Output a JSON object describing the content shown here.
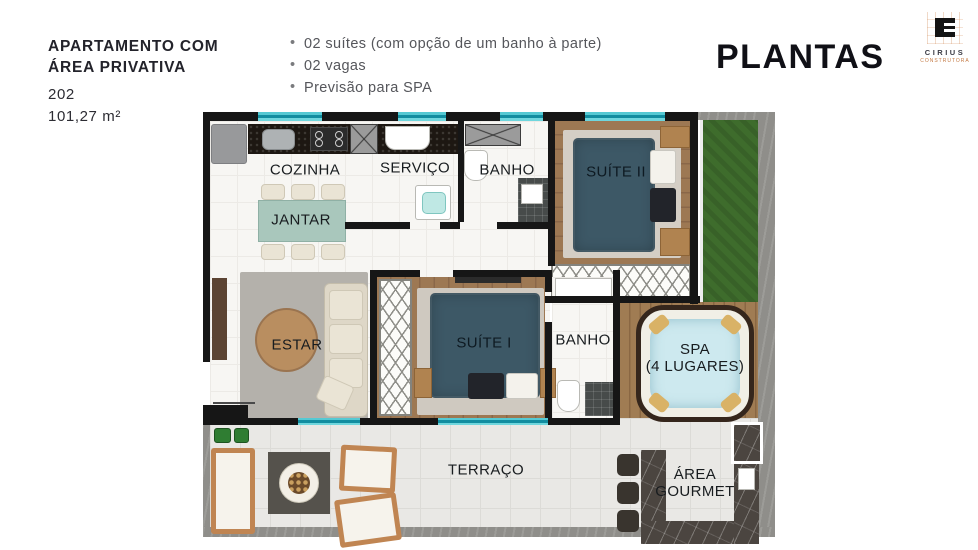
{
  "header": {
    "title_line1": "APARTAMENTO COM",
    "title_line2": "ÁREA PRIVATIVA",
    "unit": "202",
    "area": "101,27 m²",
    "bullet_glyph": "•",
    "features": [
      "02 suítes (com opção de um banho à parte)",
      "02 vagas",
      "Previsão para SPA"
    ],
    "page_title": "PLANTAS"
  },
  "logo": {
    "name": "CIRIUS",
    "subtitle": "CONSTRUTORA"
  },
  "plan": {
    "rooms": {
      "cozinha": "COZINHA",
      "servico": "SERVIÇO",
      "banho1": "BANHO",
      "suite2": "SUÍTE II",
      "jantar": "JANTAR",
      "estar": "ESTAR",
      "suite1": "SUÍTE I",
      "banho2": "BANHO",
      "spa_line1": "SPA",
      "spa_line2": "(4 LUGARES)",
      "terraco": "TERRAÇO",
      "gourmet_line1": "ÁREA",
      "gourmet_line2": "GOURMET"
    }
  },
  "colors": {
    "teal_window": "#2fb5c3",
    "bed": "#3d5866",
    "table_teal": "#a9c7bc",
    "grass": "#3e6c2c",
    "wood": "#9d7853",
    "deck": "#a07c53",
    "concrete": "#8f8e8a",
    "accent_logo": "#c47a44",
    "text_dark": "#23232b",
    "text_gray": "#55565b"
  }
}
